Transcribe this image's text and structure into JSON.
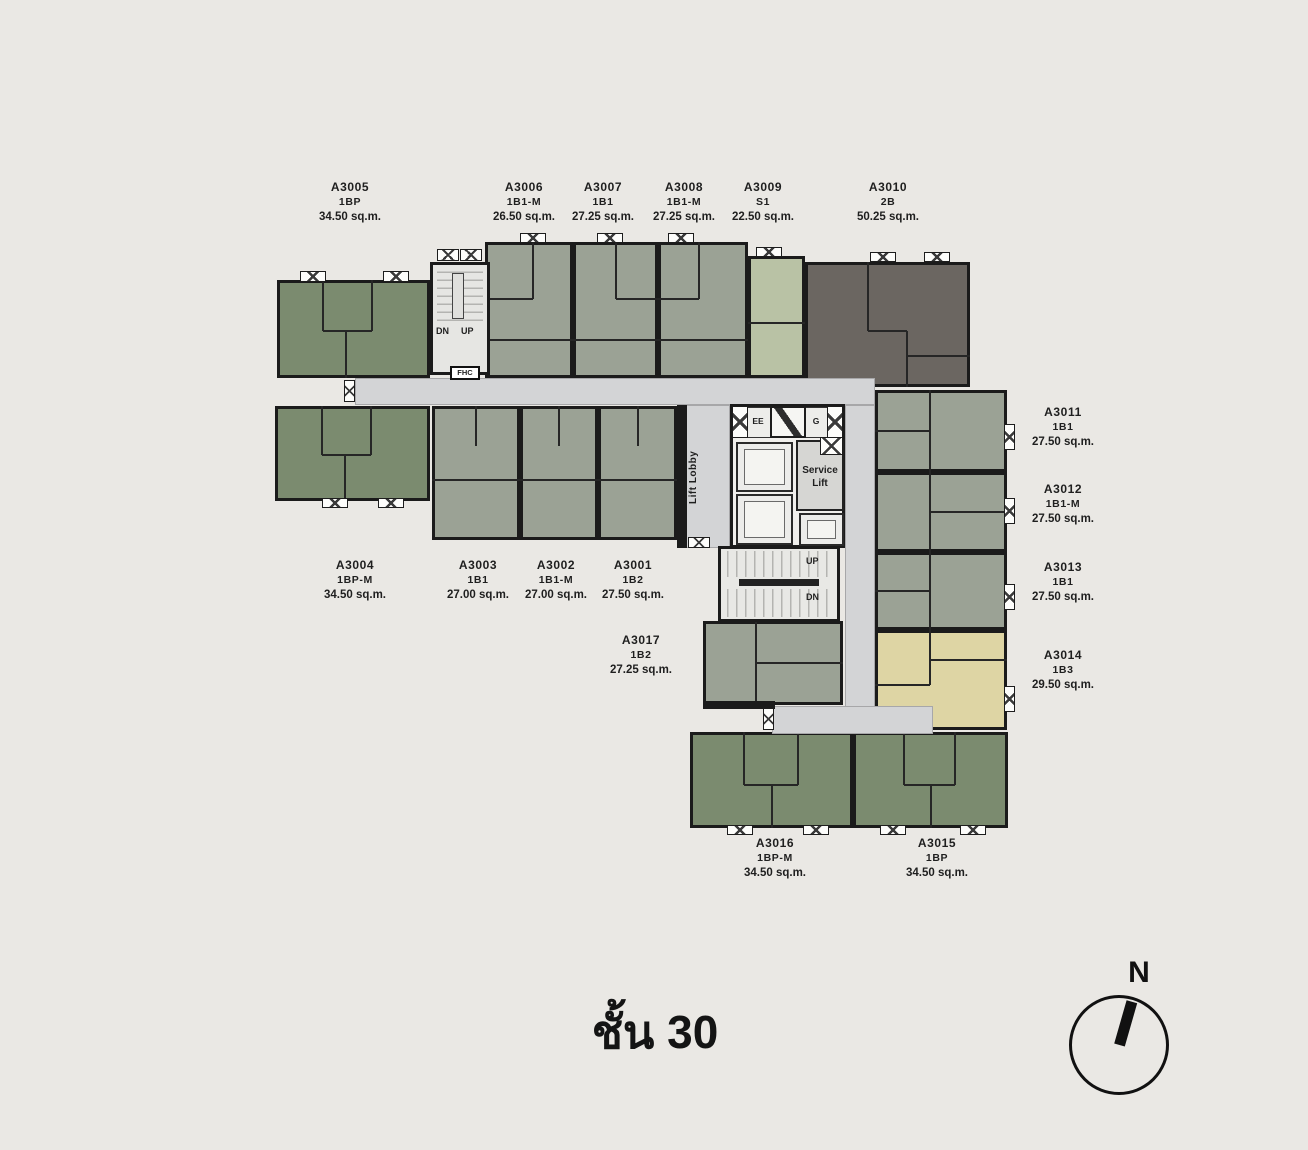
{
  "title": {
    "text": "ชั้น 30"
  },
  "compass": {
    "label": "N"
  },
  "core": {
    "lift_lobby": "Lift Lobby",
    "service_lift": "Service Lift",
    "ee": "EE",
    "g": "G",
    "stair_up": "UP",
    "stair_dn": "DN",
    "tl_stair_dn": "DN",
    "tl_stair_up": "UP",
    "fhc": "FHC"
  },
  "floorplan": {
    "colors": {
      "background": "#eae8e4",
      "wall": "#1b1b1b",
      "corridor": "#d3d4d6",
      "fills": {
        "green": "#7b8b6f",
        "gray": "#9ba295",
        "pale": "#b9c2a5",
        "dark": "#6b6661",
        "tan": "#ded5a4"
      }
    },
    "units": [
      {
        "name": "A3005",
        "type": "1BP",
        "area": "34.50 sq.m.",
        "color": "green",
        "rect": [
          277,
          280,
          153,
          98
        ],
        "label": [
          350,
          180
        ],
        "iw": [
          [
            0.3,
            0,
            0.3,
            0.52
          ],
          [
            0.3,
            0.52,
            0.62,
            0.52
          ],
          [
            0.62,
            0,
            0.62,
            0.52
          ],
          [
            0.45,
            0.52,
            0.45,
            1
          ]
        ]
      },
      {
        "name": "A3006",
        "type": "1B1-M",
        "area": "26.50 sq.m.",
        "color": "gray",
        "rect": [
          485,
          242,
          88,
          136
        ],
        "label": [
          524,
          180
        ],
        "iw": [
          [
            0.55,
            0,
            0.55,
            0.42
          ],
          [
            0,
            0.42,
            0.55,
            0.42
          ],
          [
            0,
            0.72,
            1,
            0.72
          ]
        ]
      },
      {
        "name": "A3007",
        "type": "1B1",
        "area": "27.25 sq.m.",
        "color": "gray",
        "rect": [
          573,
          242,
          85,
          136
        ],
        "label": [
          603,
          180
        ],
        "iw": [
          [
            0.5,
            0,
            0.5,
            0.42
          ],
          [
            0.5,
            0.42,
            1,
            0.42
          ],
          [
            0,
            0.72,
            1,
            0.72
          ]
        ]
      },
      {
        "name": "A3008",
        "type": "1B1-M",
        "area": "27.25 sq.m.",
        "color": "gray",
        "rect": [
          658,
          242,
          90,
          136
        ],
        "label": [
          684,
          180
        ],
        "iw": [
          [
            0.45,
            0,
            0.45,
            0.42
          ],
          [
            0,
            0.42,
            0.45,
            0.42
          ],
          [
            0,
            0.72,
            1,
            0.72
          ]
        ]
      },
      {
        "name": "A3009",
        "type": "S1",
        "area": "22.50 sq.m.",
        "color": "pale",
        "rect": [
          748,
          256,
          57,
          122
        ],
        "label": [
          763,
          180
        ],
        "iw": [
          [
            0,
            0.55,
            1,
            0.55
          ]
        ]
      },
      {
        "name": "A3010",
        "type": "2B",
        "area": "50.25 sq.m.",
        "color": "dark",
        "rect": [
          805,
          262,
          165,
          125
        ],
        "label": [
          888,
          180
        ],
        "iw": [
          [
            0.38,
            0,
            0.38,
            0.55
          ],
          [
            0.38,
            0.55,
            0.62,
            0.55
          ],
          [
            0.62,
            0.55,
            0.62,
            1
          ],
          [
            0.62,
            0.75,
            1,
            0.75
          ]
        ]
      },
      {
        "name": "A3011",
        "type": "1B1",
        "area": "27.50 sq.m.",
        "color": "gray",
        "rect": [
          875,
          390,
          132,
          82
        ],
        "label": [
          1063,
          405
        ],
        "iw": [
          [
            0.42,
            0,
            0.42,
            1
          ],
          [
            0,
            0.5,
            0.42,
            0.5
          ]
        ]
      },
      {
        "name": "A3012",
        "type": "1B1-M",
        "area": "27.50 sq.m.",
        "color": "gray",
        "rect": [
          875,
          472,
          132,
          80
        ],
        "label": [
          1063,
          482
        ],
        "iw": [
          [
            0.42,
            0,
            0.42,
            1
          ],
          [
            0.42,
            0.5,
            1,
            0.5
          ]
        ]
      },
      {
        "name": "A3013",
        "type": "1B1",
        "area": "27.50 sq.m.",
        "color": "gray",
        "rect": [
          875,
          552,
          132,
          78
        ],
        "label": [
          1063,
          560
        ],
        "iw": [
          [
            0.42,
            0,
            0.42,
            1
          ],
          [
            0,
            0.5,
            0.42,
            0.5
          ]
        ]
      },
      {
        "name": "A3014",
        "type": "1B3",
        "area": "29.50 sq.m.",
        "color": "tan",
        "rect": [
          875,
          630,
          132,
          100
        ],
        "label": [
          1063,
          648
        ],
        "iw": [
          [
            0.42,
            0,
            0.42,
            0.55
          ],
          [
            0,
            0.55,
            0.42,
            0.55
          ],
          [
            0.42,
            0.3,
            1,
            0.3
          ]
        ]
      },
      {
        "name": "A3017",
        "type": "1B2",
        "area": "27.25 sq.m.",
        "color": "gray",
        "rect": [
          703,
          621,
          140,
          84
        ],
        "label": [
          641,
          633
        ],
        "iw": [
          [
            0.38,
            0,
            0.38,
            1
          ],
          [
            0.38,
            0.5,
            1,
            0.5
          ]
        ]
      },
      {
        "name": "A3001",
        "type": "1B2",
        "area": "27.50 sq.m.",
        "color": "gray",
        "rect": [
          598,
          406,
          79,
          134
        ],
        "label": [
          633,
          558
        ],
        "iw": [
          [
            0.5,
            0,
            0.5,
            0.3
          ],
          [
            0,
            0.55,
            1,
            0.55
          ]
        ]
      },
      {
        "name": "A3002",
        "type": "1B1-M",
        "area": "27.00 sq.m.",
        "color": "gray",
        "rect": [
          520,
          406,
          78,
          134
        ],
        "label": [
          556,
          558
        ],
        "iw": [
          [
            0.5,
            0,
            0.5,
            0.3
          ],
          [
            0,
            0.55,
            1,
            0.55
          ]
        ]
      },
      {
        "name": "A3003",
        "type": "1B1",
        "area": "27.00 sq.m.",
        "color": "gray",
        "rect": [
          432,
          406,
          88,
          134
        ],
        "label": [
          478,
          558
        ],
        "iw": [
          [
            0.5,
            0,
            0.5,
            0.3
          ],
          [
            0,
            0.55,
            1,
            0.55
          ]
        ]
      },
      {
        "name": "A3004",
        "type": "1BP-M",
        "area": "34.50 sq.m.",
        "color": "green",
        "rect": [
          275,
          406,
          155,
          95
        ],
        "label": [
          355,
          558
        ],
        "iw": [
          [
            0.3,
            0,
            0.3,
            0.52
          ],
          [
            0.3,
            0.52,
            0.62,
            0.52
          ],
          [
            0.62,
            0,
            0.62,
            0.52
          ],
          [
            0.45,
            0.52,
            0.45,
            1
          ]
        ]
      },
      {
        "name": "A3016",
        "type": "1BP-M",
        "area": "34.50 sq.m.",
        "color": "green",
        "rect": [
          690,
          732,
          163,
          96
        ],
        "label": [
          775,
          836
        ],
        "iw": [
          [
            0.33,
            0,
            0.33,
            0.55
          ],
          [
            0.33,
            0.55,
            0.66,
            0.55
          ],
          [
            0.66,
            0,
            0.66,
            0.55
          ],
          [
            0.5,
            0.55,
            0.5,
            1
          ]
        ]
      },
      {
        "name": "A3015",
        "type": "1BP",
        "area": "34.50 sq.m.",
        "color": "green",
        "rect": [
          853,
          732,
          155,
          96
        ],
        "label": [
          937,
          836
        ],
        "iw": [
          [
            0.33,
            0,
            0.33,
            0.55
          ],
          [
            0.33,
            0.55,
            0.66,
            0.55
          ],
          [
            0.66,
            0,
            0.66,
            0.55
          ],
          [
            0.5,
            0.55,
            0.5,
            1
          ]
        ]
      }
    ],
    "corridors": [
      [
        355,
        378,
        520,
        27
      ],
      [
        684,
        405,
        46,
        143
      ],
      [
        845,
        405,
        30,
        329
      ],
      [
        772,
        706,
        161,
        28
      ]
    ],
    "walls": [
      [
        677,
        405,
        10,
        143
      ],
      [
        703,
        701,
        72,
        8
      ]
    ],
    "markers": [
      [
        300,
        271,
        26,
        11
      ],
      [
        383,
        271,
        26,
        11
      ],
      [
        437,
        249,
        22,
        12
      ],
      [
        460,
        249,
        22,
        12
      ],
      [
        520,
        233,
        26,
        10
      ],
      [
        597,
        233,
        26,
        10
      ],
      [
        668,
        233,
        26,
        10
      ],
      [
        756,
        247,
        26,
        10
      ],
      [
        870,
        252,
        26,
        10
      ],
      [
        924,
        252,
        26,
        10
      ],
      [
        1004,
        424,
        11,
        26
      ],
      [
        1004,
        498,
        11,
        26
      ],
      [
        1004,
        584,
        11,
        26
      ],
      [
        1004,
        686,
        11,
        26
      ],
      [
        344,
        380,
        11,
        22
      ],
      [
        322,
        498,
        26,
        10
      ],
      [
        378,
        498,
        26,
        10
      ],
      [
        688,
        537,
        22,
        11
      ],
      [
        727,
        825,
        26,
        10
      ],
      [
        803,
        825,
        26,
        10
      ],
      [
        880,
        825,
        26,
        10
      ],
      [
        960,
        825,
        26,
        10
      ],
      [
        763,
        708,
        11,
        22
      ]
    ]
  }
}
